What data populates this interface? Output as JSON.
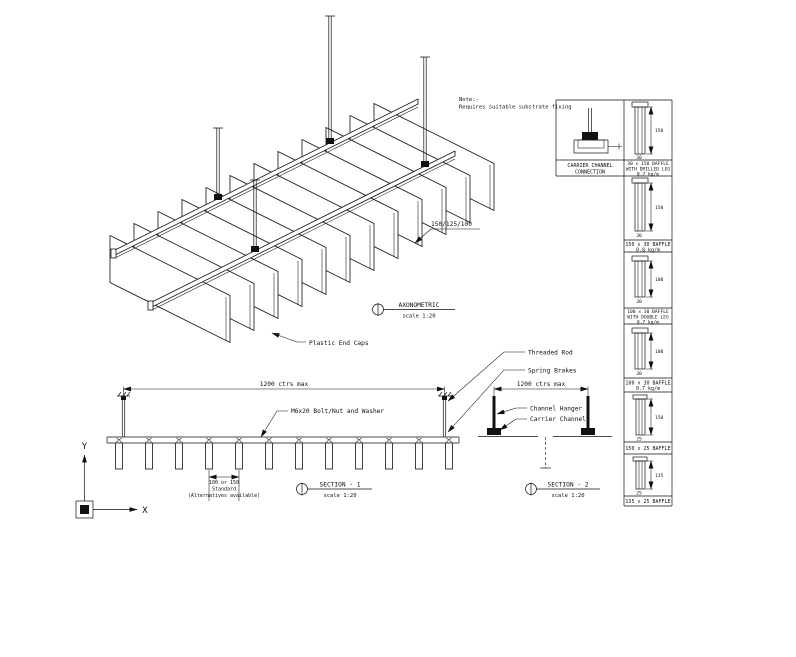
{
  "colors": {
    "ink": "#111111",
    "bg": "#ffffff"
  },
  "note": {
    "line1": "Note:-",
    "line2": "Requires suitable substrate fixing"
  },
  "axonometric": {
    "title": "AXONOMETRIC",
    "scale": "scale 1:20"
  },
  "iso": {
    "depth_dim": "150/125/100",
    "end_caps_label": "Plastic End Caps"
  },
  "section1": {
    "title": "SECTION - 1",
    "scale": "scale 1:20",
    "dim_top": "1200 ctrs max",
    "bolt_label": "M6x20 Bolt/Nut and Washer",
    "threaded_rod_label": "Threaded Rod",
    "spring_label": "Spring Brakes",
    "dim_bottom_line1": "100 or 150",
    "dim_bottom_line2": "Standard",
    "dim_bottom_line3": "(Alternatives available)"
  },
  "section2": {
    "title": "SECTION - 2",
    "scale": "scale 1:20",
    "dim_top": "1200 ctrs max",
    "hanger_label": "Channel Hanger",
    "carrier_label": "Carrier Channel"
  },
  "axis": {
    "x_label": "X",
    "y_label": "Y"
  },
  "details": {
    "carrier_panel": {
      "lines": [
        "CARRIER CHANNEL",
        "CONNECTION"
      ]
    },
    "panels": [
      {
        "lines": [
          "30 x 150 BAFFLE",
          "WITH DRILLED LEG",
          "0.7 kg/m"
        ],
        "dim_h": "150",
        "dim_w": "30"
      },
      {
        "lines": [
          "150 x 30 BAFFLE",
          "0.8 kg/m"
        ],
        "dim_h": "150",
        "dim_w": "30"
      },
      {
        "lines": [
          "100 x 30 BAFFLE",
          "WITH DOUBLE LEG",
          "0.7 kg/m"
        ],
        "dim_h": "100",
        "dim_w": "30"
      },
      {
        "lines": [
          "100 x 30 BAFFLE",
          "0.7 kg/m"
        ],
        "dim_h": "100",
        "dim_w": "30"
      },
      {
        "lines": [
          "150 x 25 BAFFLE"
        ],
        "dim_h": "150",
        "dim_w": "25"
      },
      {
        "lines": [
          "135 x 25 BAFFLE"
        ],
        "dim_h": "135",
        "dim_w": "25"
      }
    ]
  }
}
